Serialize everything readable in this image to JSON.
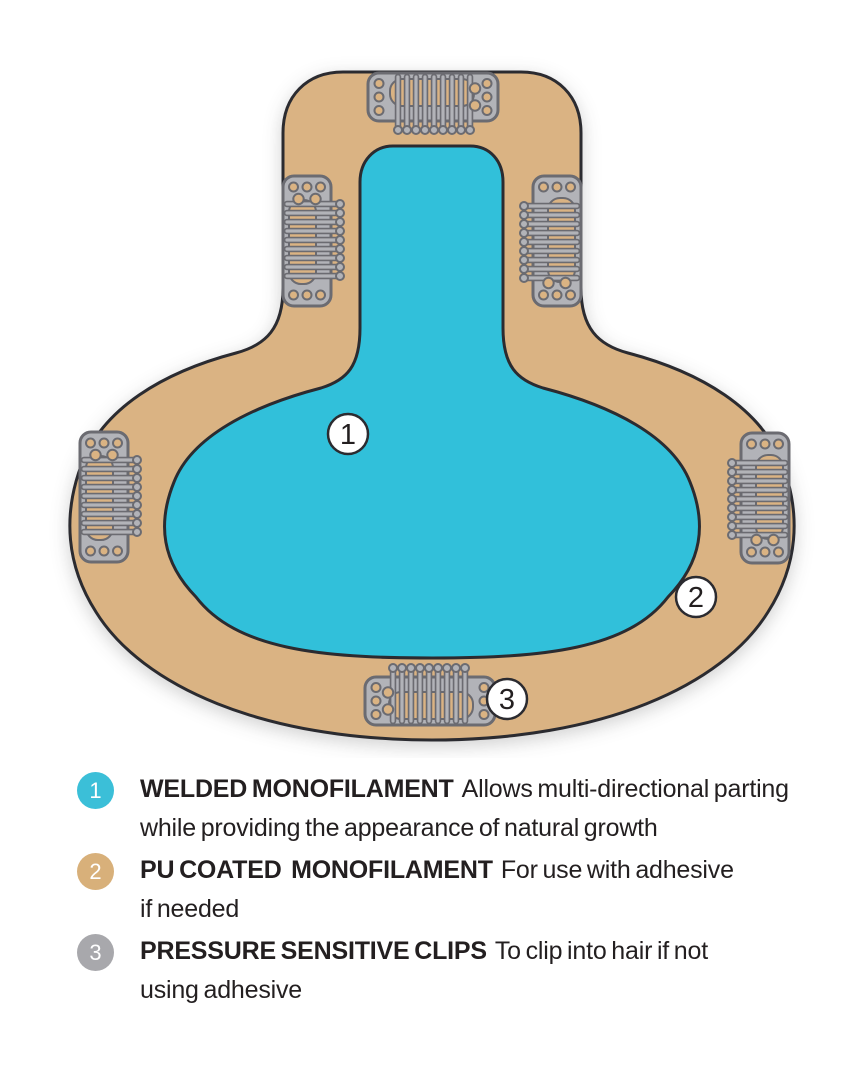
{
  "colors": {
    "page-bg": "#ffffff",
    "teal": "#31c0da",
    "tan": "#dab383",
    "outline": "#2b2b30",
    "clip-gray": "#b2b3b8",
    "clip-outline": "#6b6b71",
    "badge-teal": "#3bbfd8",
    "badge-tan": "#d8b07a",
    "badge-gray": "#a8a8ac",
    "text": "#231f20"
  },
  "diagram": {
    "callouts": [
      {
        "label": "1"
      },
      {
        "label": "2"
      },
      {
        "label": "3"
      }
    ],
    "clips": [
      {
        "position": "top"
      },
      {
        "position": "upper-left"
      },
      {
        "position": "upper-right"
      },
      {
        "position": "left"
      },
      {
        "position": "right"
      },
      {
        "position": "bottom"
      }
    ]
  },
  "legend": {
    "items": [
      {
        "number": "1",
        "term": "WELDED MONOFILAMENT",
        "desc_line1": "Allows multi-directional parting",
        "desc_line2": "while providing the appearance of natural growth"
      },
      {
        "number": "2",
        "term": "PU COATED  MONOFILAMENT",
        "desc_line1": "For use with adhesive",
        "desc_line2": "if needed"
      },
      {
        "number": "3",
        "term": "PRESSURE SENSITIVE CLIPS",
        "desc_line1": "To clip into hair if not",
        "desc_line2": "using adhesive"
      }
    ]
  }
}
